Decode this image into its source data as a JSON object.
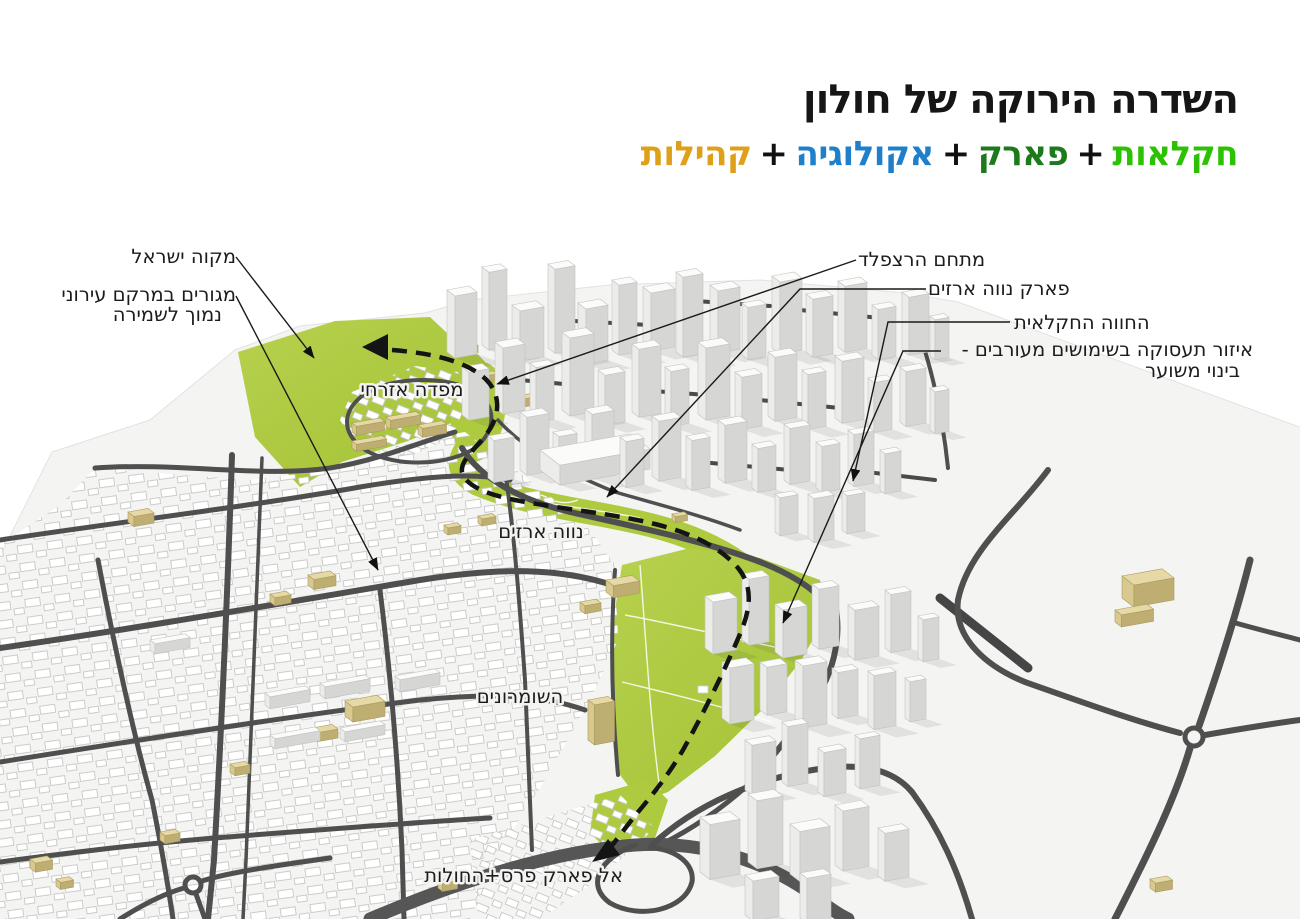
{
  "header": {
    "title": "השדרה הירוקה של חולון",
    "sep": "+",
    "parts": {
      "agriculture": {
        "text": "חקלאות",
        "style": "color:#2dc104"
      },
      "park": {
        "text": "פארק",
        "style": "color:#1d7a1c"
      },
      "ecology": {
        "text": "אקולוגיה",
        "style": "color:#1e7fcb"
      },
      "communities": {
        "text": "קהילות",
        "style": "color:#dfa019"
      }
    }
  },
  "map": {
    "annotations": {
      "mikveh_israel": "מקוה ישראל",
      "housing_line1": "מגורים במרקם עירוני",
      "housing_line2": "נמוך לשמירה",
      "herzfeld": "מתחם הרצפלד",
      "neve_arazim_park": "פארק נווה ארזים",
      "agricultural_farm": "החווה החקלאית",
      "employment_line1": "איזור תעסוקה בשימושים מעורבים -",
      "employment_line2": "בינוי משוער",
      "mifde_ezrahi": "מפדה אזרחי",
      "neve_arazim": "נווה ארזים",
      "hashomronim": "השומרונים",
      "to_peres_park": "אל פארק פרס+החולות"
    },
    "colors": {
      "park_green": "#aecb3f",
      "road_gray": "#4f4f4f",
      "tan_building": "#d9c98f",
      "route_black": "#141414"
    }
  }
}
